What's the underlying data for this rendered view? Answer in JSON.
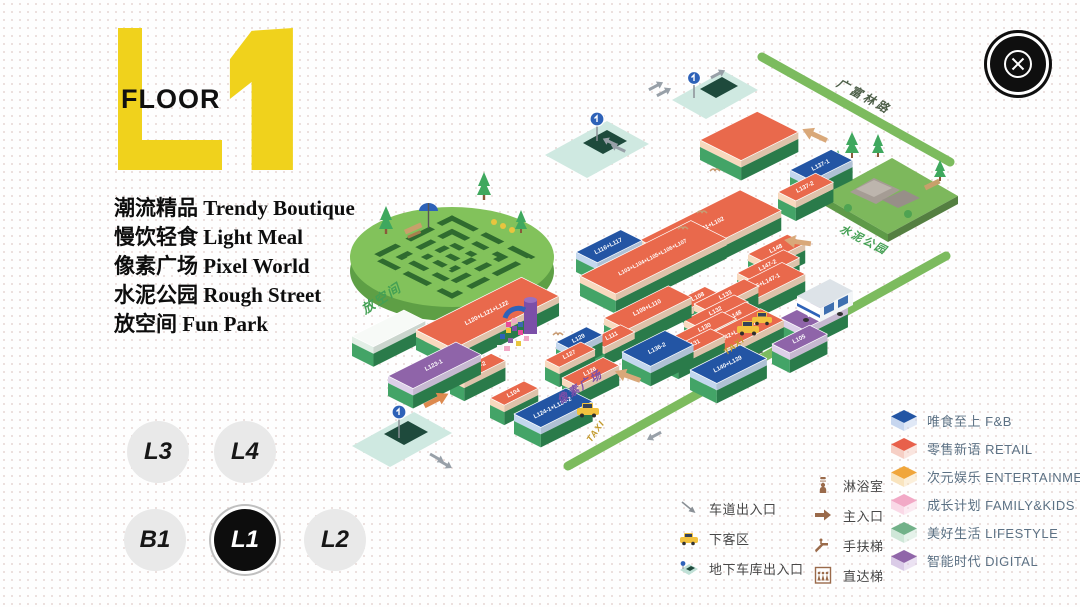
{
  "logo": {
    "floor_label": "FLOOR",
    "accent": "#F0D21C"
  },
  "categories": [
    {
      "zh": "潮流精品",
      "en": "Trendy Boutique"
    },
    {
      "zh": "慢饮轻食",
      "en": "Light Meal"
    },
    {
      "zh": "像素广场",
      "en": "Pixel World"
    },
    {
      "zh": "水泥公园",
      "en": "Rough Street"
    },
    {
      "zh": "放空间",
      "en": "Fun Park"
    }
  ],
  "floor_nav": {
    "selected": "L1",
    "buttons": [
      {
        "label": "L3"
      },
      {
        "label": "L4"
      },
      {
        "label": "B1"
      },
      {
        "label": "L1"
      },
      {
        "label": "L2"
      }
    ]
  },
  "map": {
    "labels": {
      "guangfulin_road": "广富林路",
      "renmin_north_road": "人民北路",
      "fun_park": "放空间",
      "cement_park": "水泥公园",
      "pixel_plaza": "像素广场",
      "taxi": "TAXI"
    },
    "palette": {
      "base_sw": "#43A467",
      "base_se": "#2F8A53",
      "types": {
        "retail": {
          "top": "#E9694C",
          "band": "#F8D9BE"
        },
        "fnb": {
          "top": "#2355A4",
          "band": "#C3D7EE"
        },
        "digital": {
          "top": "#8F64A9",
          "band": "#DDCFE9"
        },
        "walk": {
          "top": "#F7FAF7",
          "band": "#E2EFE6"
        }
      }
    },
    "blocks": [
      {
        "l": "",
        "c": "retail",
        "x": 700,
        "y": 140,
        "a": 64,
        "b": 46
      },
      {
        "l": "L137-1",
        "c": "fnb",
        "x": 790,
        "y": 170,
        "a": 46,
        "b": 24
      },
      {
        "l": "L137-2",
        "c": "retail",
        "x": 778,
        "y": 192,
        "a": 42,
        "b": 20
      },
      {
        "l": "L101+L102",
        "c": "retail",
        "x": 640,
        "y": 240,
        "a": 112,
        "b": 46
      },
      {
        "l": "L148",
        "c": "retail",
        "x": 748,
        "y": 254,
        "a": 44,
        "b": 20
      },
      {
        "l": "L147-2",
        "c": "retail",
        "x": 737,
        "y": 273,
        "a": 52,
        "b": 18
      },
      {
        "l": "L146+L147-1",
        "c": "retail",
        "x": 723,
        "y": 292,
        "a": 66,
        "b": 26
      },
      {
        "l": "L116+L117",
        "c": "fnb",
        "x": 576,
        "y": 252,
        "a": 50,
        "b": 24
      },
      {
        "l": "L103+L104+L105+L106+L107",
        "c": "retail",
        "x": 580,
        "y": 276,
        "a": 124,
        "b": 40,
        "f": 5.5
      },
      {
        "l": "L148",
        "c": "retail",
        "x": 710,
        "y": 320,
        "a": 40,
        "b": 18
      },
      {
        "l": "L142+L143+L144",
        "c": "retail",
        "x": 698,
        "y": 340,
        "a": 70,
        "b": 26
      },
      {
        "l": "L109+L110",
        "c": "retail",
        "x": 604,
        "y": 318,
        "a": 72,
        "b": 26
      },
      {
        "l": "L108",
        "c": "retail",
        "x": 678,
        "y": 300,
        "a": 30,
        "b": 16
      },
      {
        "l": "L111",
        "c": "retail",
        "x": 590,
        "y": 340,
        "a": 34,
        "b": 16
      },
      {
        "l": "L133",
        "c": "retail",
        "x": 694,
        "y": 304,
        "a": 56,
        "b": 16
      },
      {
        "l": "L132",
        "c": "retail",
        "x": 684,
        "y": 320,
        "a": 56,
        "b": 16
      },
      {
        "l": "L106",
        "c": "digital",
        "x": 780,
        "y": 318,
        "a": 50,
        "b": 26
      },
      {
        "l": "L130",
        "c": "retail",
        "x": 674,
        "y": 336,
        "a": 54,
        "b": 16
      },
      {
        "l": "L105",
        "c": "digital",
        "x": 772,
        "y": 344,
        "a": 42,
        "b": 20
      },
      {
        "l": "L131",
        "c": "retail",
        "x": 664,
        "y": 352,
        "a": 52,
        "b": 16
      },
      {
        "l": "L140+L139",
        "c": "fnb",
        "x": 690,
        "y": 370,
        "a": 56,
        "b": 30
      },
      {
        "l": "L136-2",
        "c": "fnb",
        "x": 622,
        "y": 352,
        "a": 48,
        "b": 32
      },
      {
        "l": "L129",
        "c": "fnb",
        "x": 556,
        "y": 342,
        "a": 34,
        "b": 18
      },
      {
        "l": "L127",
        "c": "retail",
        "x": 545,
        "y": 360,
        "a": 40,
        "b": 16
      },
      {
        "l": "L126",
        "c": "retail",
        "x": 562,
        "y": 378,
        "a": 46,
        "b": 18
      },
      {
        "l": "",
        "c": "walk",
        "x": 352,
        "y": 336,
        "a": 58,
        "b": 24
      },
      {
        "l": "L120+L121+L122",
        "c": "retail",
        "x": 416,
        "y": 330,
        "a": 118,
        "b": 42
      },
      {
        "l": "L123-2",
        "c": "retail",
        "x": 450,
        "y": 374,
        "a": 46,
        "b": 16
      },
      {
        "l": "L123-1",
        "c": "digital",
        "x": 388,
        "y": 376,
        "a": 76,
        "b": 28
      },
      {
        "l": "L104",
        "c": "retail",
        "x": 490,
        "y": 398,
        "a": 38,
        "b": 16
      },
      {
        "l": "L124-1+L124-2",
        "c": "fnb",
        "x": 514,
        "y": 414,
        "a": 58,
        "b": 30
      }
    ]
  },
  "legend_categories": [
    {
      "label": "唯食至上 F&B",
      "color": "#2355A4",
      "light": "#C7D6EF"
    },
    {
      "label": "零售新语 RETAIL",
      "color": "#E8604B",
      "light": "#F6CFC5"
    },
    {
      "label": "次元娱乐 ENTERTAINMENT",
      "color": "#F0A63C",
      "light": "#F9E4BE"
    },
    {
      "label": "成长计划 FAMILY&KIDS",
      "color": "#F2A9C6",
      "light": "#FAD9E7"
    },
    {
      "label": "美好生活 LIFESTYLE",
      "color": "#72B189",
      "light": "#CFE7D8"
    },
    {
      "label": "智能时代 DIGITAL",
      "color": "#9066A9",
      "light": "#DACBE7"
    }
  ],
  "legend_facilities": {
    "col1": [
      {
        "label": "车道出入口"
      },
      {
        "label": "下客区"
      },
      {
        "label": "地下车库出入口"
      }
    ],
    "col2": [
      {
        "label": "淋浴室"
      },
      {
        "label": "主入口"
      },
      {
        "label": "手扶梯"
      },
      {
        "label": "直达梯"
      }
    ]
  }
}
